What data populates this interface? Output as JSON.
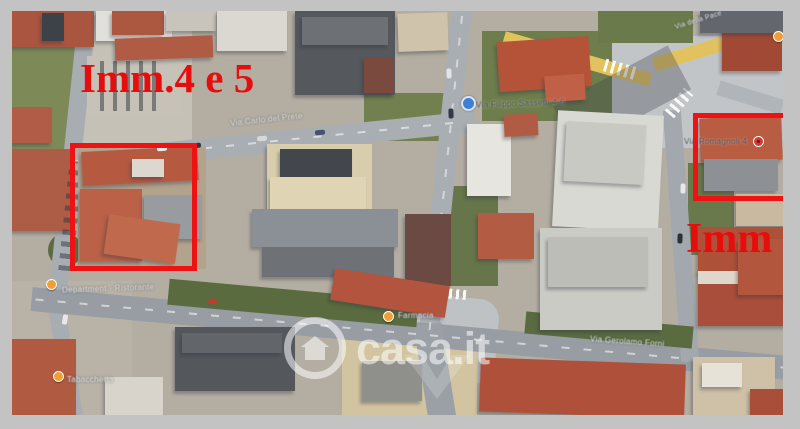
{
  "image_type": "satellite-aerial-map",
  "frame": {
    "border_color": "#c3c3c3"
  },
  "annotations": {
    "left_label": "Imm.4 e 5",
    "right_label": "Imm",
    "text_color": "#e60d0d",
    "box_color": "#ee1212"
  },
  "watermark": {
    "text": "casa.it",
    "color": "#ffffff",
    "icon": "house-in-circle-icon"
  },
  "street_labels": {
    "top_road": "Via Carlo del Prete",
    "yellow_road": "Via della Pace",
    "center_street": "Via Filippo Sassetti 4-6",
    "right_street": "Via Romagnoli 4",
    "bottom_road": "Via Gerolamo Forni",
    "restaurant_poi": "Department · Ristorante",
    "tobacco_poi": "Tabaccheria",
    "pharmacy_poi": "Farmacia"
  },
  "markers": {
    "orange_pin_icon": "poi-pin-orange",
    "blue_dot_icon": "transit-blue-dot",
    "red_dot_icon": "poi-dot-red"
  },
  "palette": {
    "roof_red": "#b2543e",
    "road_gray": "#a9aeb3",
    "road_yellow": "#e2c25f",
    "vegetation": "#6e7d4c"
  }
}
